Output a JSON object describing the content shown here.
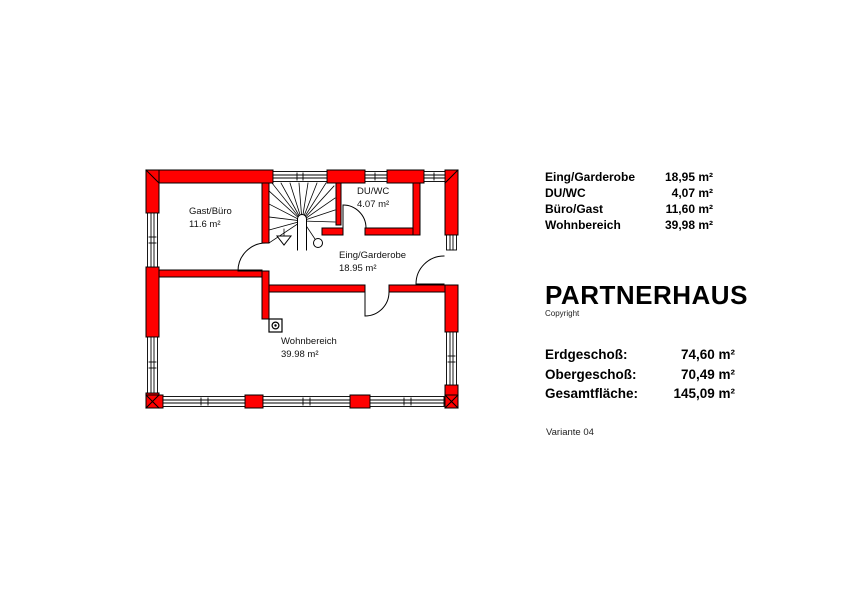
{
  "plan": {
    "rooms": [
      {
        "name": "Gast/Büro",
        "area": "11.6 m²"
      },
      {
        "name": "DU/WC",
        "area": "4.07 m²"
      },
      {
        "name": "Eing/Garderobe",
        "area": "18.95 m²"
      },
      {
        "name": "Wohnbereich",
        "area": "39.98 m²"
      }
    ]
  },
  "legend": {
    "rooms": [
      {
        "name": "Eing/Garderobe",
        "area": "18,95 m²"
      },
      {
        "name": "DU/WC",
        "area": "4,07 m²"
      },
      {
        "name": "Büro/Gast",
        "area": "11,60 m²"
      },
      {
        "name": "Wohnbereich",
        "area": "39,98 m²"
      }
    ]
  },
  "brand": {
    "title": "PARTNERHAUS",
    "copyright": "Copyright"
  },
  "totals": [
    {
      "label": "Erdgeschoß:",
      "value": "74,60 m²"
    },
    {
      "label": "Obergeschoß:",
      "value": "70,49 m²"
    },
    {
      "label": "Gesamtfläche:",
      "value": "145,09 m²"
    }
  ],
  "variant": "Variante 04",
  "colors": {
    "wall": "#ff0000",
    "line": "#000000",
    "background": "#ffffff"
  }
}
